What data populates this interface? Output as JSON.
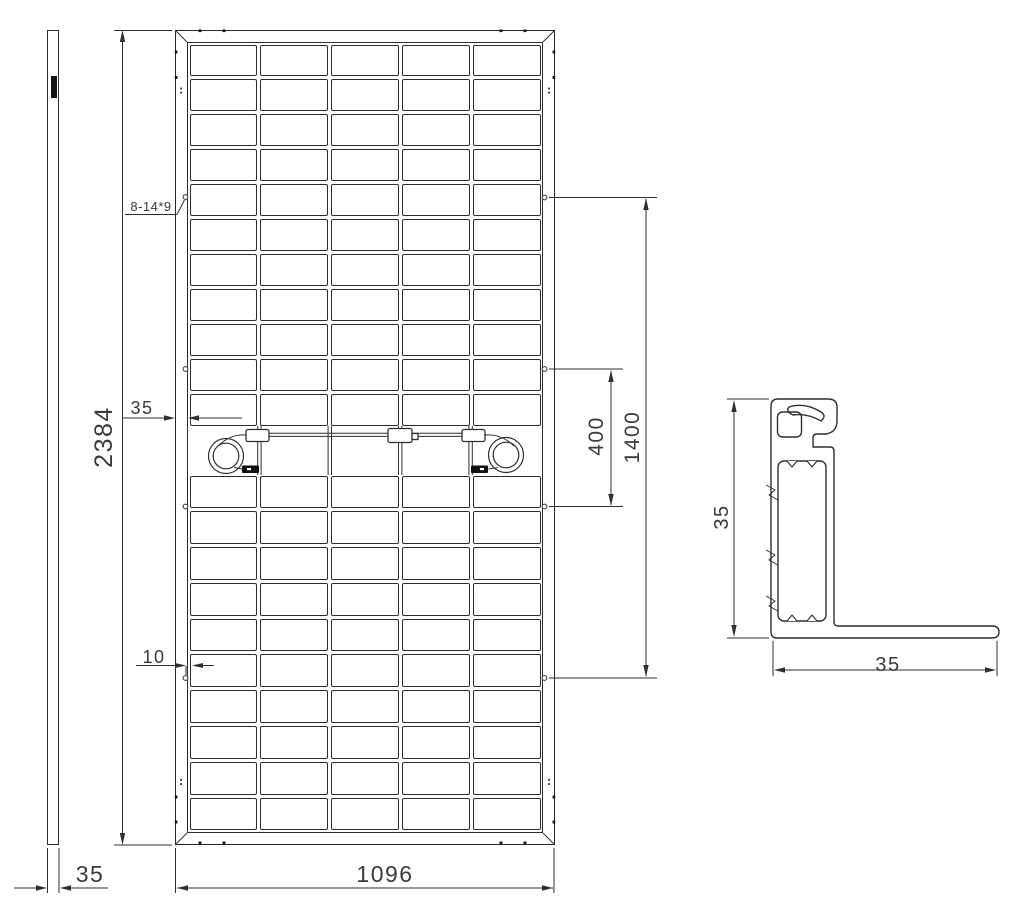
{
  "document": {
    "type": "engineering-drawing",
    "subject": "Solar module rear view with side profile and frame cross-section"
  },
  "labels": {
    "side_thickness": "35",
    "module_height": "2384",
    "module_width": "1096",
    "frame_face_width": "35",
    "grounding_hole_offset": "10",
    "mounting_slots_note": "8-14*9",
    "mounting_hole_span": "400",
    "mounting_hole_outer_span": "1400",
    "section_height": "35",
    "section_flange_depth": "35"
  },
  "panel": {
    "columns": 5,
    "rows_upper": 11,
    "rows_lower": 10
  },
  "colors": {
    "line": "#2f2f2f",
    "text": "#3a3a3a",
    "background": "#ffffff",
    "connector_fill": "#111111"
  }
}
